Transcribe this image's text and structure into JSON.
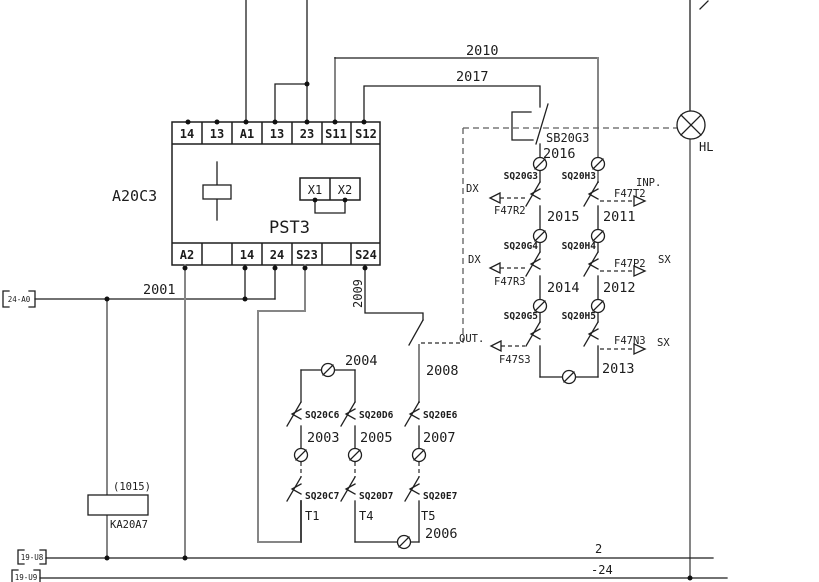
{
  "schematic": {
    "module": {
      "ref": "A20C3",
      "model": "PST3",
      "terminals_top": [
        "14",
        "13",
        "A1",
        "13",
        "23",
        "S11",
        "S12"
      ],
      "terminals_bottom": [
        "A2",
        "14",
        "24",
        "S23",
        "S24"
      ],
      "aux_terminals": {
        "x1": "X1",
        "x2": "X2"
      }
    },
    "wires": {
      "w2010": "2010",
      "w2017": "2017",
      "w2016": "2016",
      "w2001": "2001",
      "w2009": "2009",
      "w2008": "2008",
      "w2004": "2004",
      "w2003": "2003",
      "w2005": "2005",
      "w2007": "2007",
      "w2006": "2006",
      "w2015": "2015",
      "w2011": "2011",
      "w2014": "2014",
      "w2012": "2012",
      "w2013": "2013"
    },
    "components": {
      "pushbutton": "SB20G3",
      "lamp": "HL",
      "relay": "KA20A7",
      "relay_note": "(1015)"
    },
    "limit_switches": {
      "g3": "SQ20G3",
      "h3": "SQ20H3",
      "g4": "SQ20G4",
      "h4": "SQ20H4",
      "g5": "SQ20G5",
      "h5": "SQ20H5",
      "c6": "SQ20C6",
      "d6": "SQ20D6",
      "e6": "SQ20E6",
      "c7": "SQ20C7",
      "d7": "SQ20D7",
      "e7": "SQ20E7"
    },
    "signal_refs": {
      "r2": "F47R2",
      "t2": "F47T2",
      "r3": "F47R3",
      "p2": "F47P2",
      "s3": "F47S3",
      "n3": "F47N3"
    },
    "direction_labels": {
      "dx1": "DX",
      "dx2": "DX",
      "sx1": "SX",
      "sx2": "SX",
      "inp": "INP.",
      "out": "OUT."
    },
    "timer_labels": {
      "t1": "T1",
      "t4": "T4",
      "t5": "T5"
    },
    "cross_refs": {
      "left": "24-A0",
      "bottom1": "19-U8",
      "bottom2": "19-U9"
    },
    "bus_labels": {
      "line2": "2",
      "minus24": "-24"
    }
  }
}
